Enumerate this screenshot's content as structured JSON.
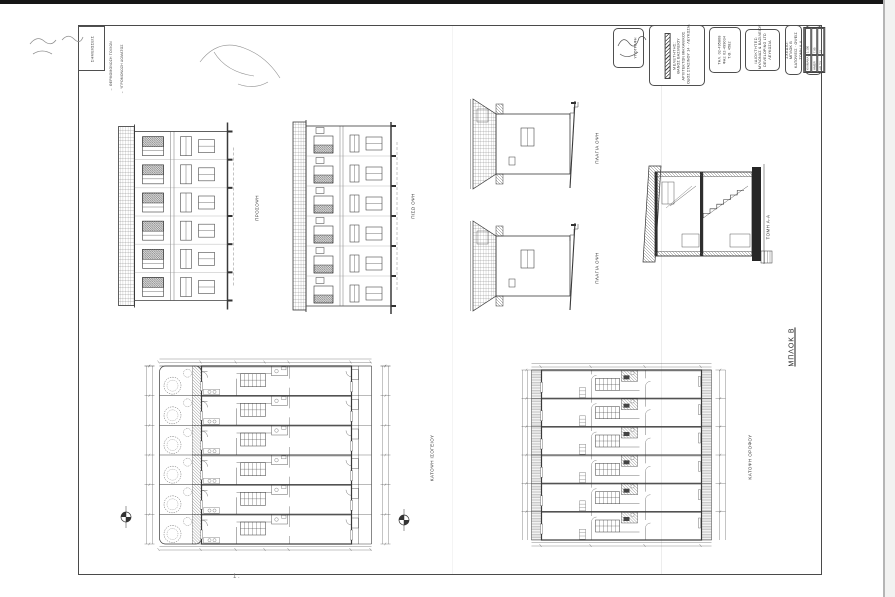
{
  "sheet": {
    "block_title": "ΜΠΛΟΚ Β",
    "page_mark": "1 .",
    "notes_label": "ΣΗΜΕΙΩΣΕΙΣ",
    "legend": {
      "item1": "← ΘΕΡΜΟΜΟΝΩΣΗ ΤΟΙΧΩΝ",
      "item2": "← ΥΓΡΟΜΟΝΩΣΗ ΔΩΜΑΤΟΣ"
    }
  },
  "labels": {
    "front_elevation": "ΠΡΟΣΟΨΗ",
    "rear_elevation": "ΠΙΣΩ ΟΨΗ",
    "side_elevation_top": "ΠΛΑΓΙΑ ΟΨΗ",
    "side_elevation_bottom": "ΠΛΑΓΙΑ ΟΨΗ",
    "section": "ΤΟΜΗ Α-Α",
    "ground_floor_plan": "ΚΑΤΟΨΗ ΙΣΟΓΕΙΟΥ",
    "upper_floor_plan": "ΚΑΤΟΨΗ ΟΡΟΦΟΥ"
  },
  "title_block": {
    "signature_caption": "ΥΠΟΓΡΑΦΗ",
    "architect": {
      "l1": "ΜΕΛΕΤΗΤΗΣ:",
      "l2": "ΘΑΝΟΣ ΒΑΣΙΛΕΙΟΥ",
      "l3": "ΑΡΧΙΤΕΚΤΩΝ ΜΗΧΑΝΙΚΟΣ",
      "l4": "ΟΔΟΣ ΣΤΑΣΙΝΟΥ 14 · ΛΕΥΚΩΣΙΑ"
    },
    "phone": {
      "l1": "ΤΗΛ. 02-495868",
      "l2": "ΦΑΞ 02-499034",
      "l3": "Τ.Θ. 4582"
    },
    "owner": {
      "l1": "ΙΔΙΟΚΤΗΤΕΣ:",
      "l2": "ΜΥΛΩΝΑΣ & ΒΑΣΙΛΕΙΟΥ",
      "l3": "DEVELOPING LTD",
      "l4": "ΛΕΥΚΩΣΙΑ"
    },
    "drawing": {
      "l1": "ΣΧΕΔΙΟ:",
      "l2": "ΜΠΛΟΚ Β",
      "l3": "ΚΑΤΟΨΕΙΣ · ΟΨΕΙΣ",
      "l4": "ΤΟΜΗ Α-Α"
    },
    "table": {
      "r1c1": "ΚΛΙΜΑΚΑ",
      "r1c2": "1:100",
      "r2c1": "ΗΜΕΡ.",
      "r2c2": "7.95",
      "r3c1": "ΑΡ. ΣΧ.",
      "r3c2": "33"
    }
  },
  "colors": {
    "ink": "#3a3a3a",
    "paper": "#ffffff"
  }
}
